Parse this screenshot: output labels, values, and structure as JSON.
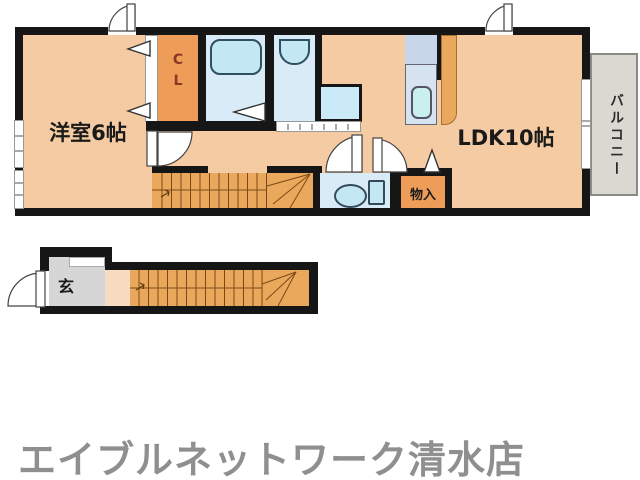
{
  "floor_plan": {
    "upper_floor": {
      "western_room_label": "洋室6帖",
      "closet_label_top": "C",
      "closet_label_bottom": "L",
      "ldk_label": "LDK10帖",
      "balcony_label": "バルコニー",
      "storage_label": "物入"
    },
    "lower_floor": {
      "entrance_label": "玄"
    }
  },
  "footer": {
    "store_name": "エイブルネットワーク清水店"
  },
  "colors": {
    "wall": "#161616",
    "peach": "#F5CBA3",
    "peach_light": "#F7DCC2",
    "orange": "#EE9D58",
    "stairs": "#EAA85C",
    "blue": "#D8EBF7",
    "fixture": "#C3E8F4",
    "counter_top": "#C7D6E8",
    "counter_bottom": "#D6E4F1",
    "balcony": "#DBD8D2",
    "entrance_gray": "#D6D6D6",
    "footer_gray": "#8F8F8F"
  }
}
